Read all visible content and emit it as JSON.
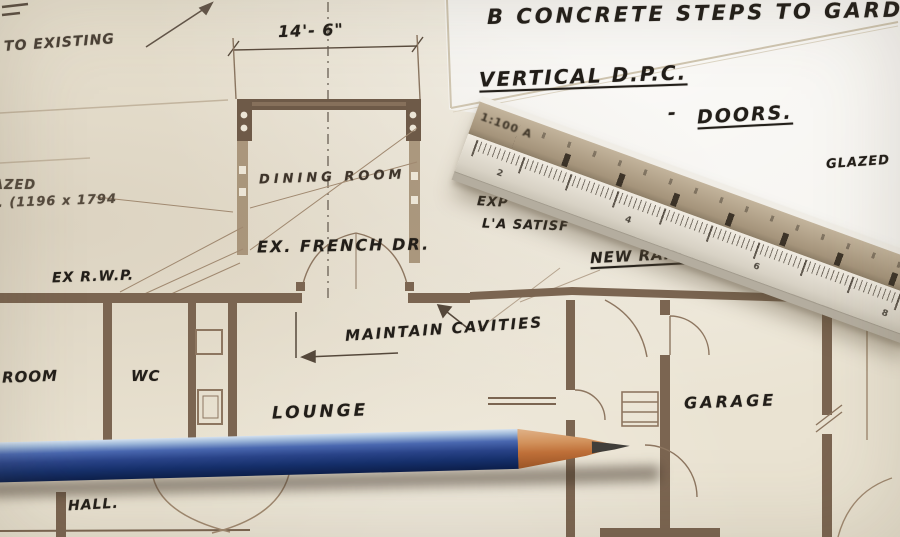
{
  "colors": {
    "paper": "#eae3d2",
    "sheet": "#f5f3ee",
    "ink": "#221e19",
    "plan-line": "#a08970",
    "plan-wall": "#77624e",
    "pencil-blue": "#2a4489",
    "pencil-highlight": "#9db7d9",
    "pencil-wood": "#c0713a",
    "pencil-tip": "#403e3a",
    "ruler-tan": "#a5947b",
    "ruler-white": "#e3ddd2"
  },
  "annotations": {
    "top": {
      "concrete_steps": "B CONCRETE STEPS TO GARDEN",
      "vertical_dpc": "VERTICAL D.P.C.",
      "doors": "DOORS.",
      "doors_dash": "-",
      "glazed_right": "GLAZED",
      "to_existing": "TO EXISTING"
    },
    "plan": {
      "dim_width": "14'- 6\"",
      "dining_room": "DINING ROOM",
      "ex_french_dr": "EX. FRENCH DR.",
      "glazed_spec": "GLAZED",
      "glazed_size": "J. (1196 x 1794",
      "ex_rwp": "EX R.W.P.",
      "exp_note": "EXP",
      "satisf_note": "L'A SATISF",
      "new_rain_water": "NEW RAIN WATER",
      "maintain_cavities": "MAINTAIN CAVITIES",
      "b_room": "B'ROOM",
      "wc": "WC",
      "lounge": "LOUNGE",
      "hall": "HALL.",
      "garage": "GARAGE"
    }
  },
  "ruler": {
    "scale_label": "1:100 A",
    "face_numbers": [
      "2",
      "4",
      "6",
      "8"
    ]
  }
}
